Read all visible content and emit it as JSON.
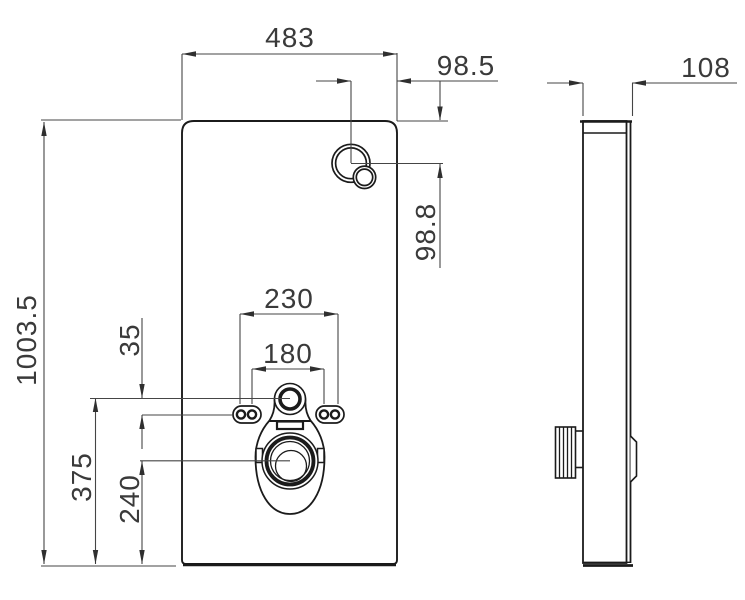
{
  "drawing": {
    "type": "technical-dimension-drawing",
    "views": {
      "front": "front-view-panel",
      "side": "side-view-profile"
    },
    "dimensions": {
      "panel_width": "483",
      "overall_height": "1003.5",
      "module_depth": "108",
      "water_offset_x": "98.5",
      "water_offset_y": "98.8",
      "bolt_spacing_outer": "230",
      "bolt_spacing_inner": "180",
      "bolt_offset": "35",
      "inlet_height": "375",
      "drain_height": "240"
    },
    "colors": {
      "background": "#ffffff",
      "object_line": "#1b1b1b",
      "dimension_line": "#454545",
      "text": "#3a3a3a"
    }
  }
}
